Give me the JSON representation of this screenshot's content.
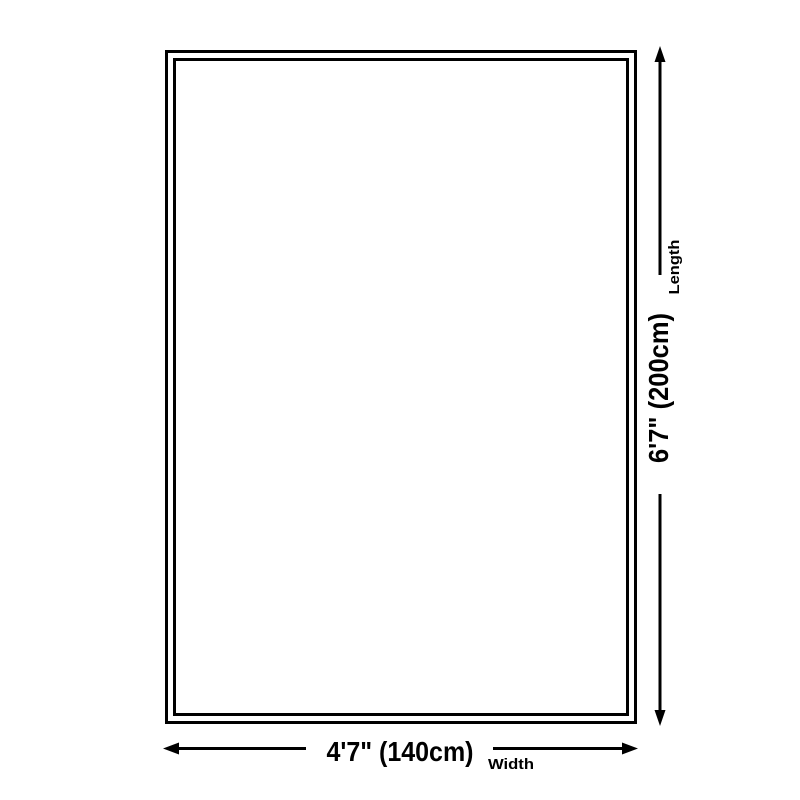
{
  "diagram": {
    "type": "product-size-diagram",
    "length": {
      "value": "6'7\" (200cm)",
      "name": "Length"
    },
    "width": {
      "value": "4'7\" (140cm)",
      "name": "Width"
    },
    "colors": {
      "line": "#000000",
      "text": "#000000",
      "background": "#ffffff"
    }
  }
}
